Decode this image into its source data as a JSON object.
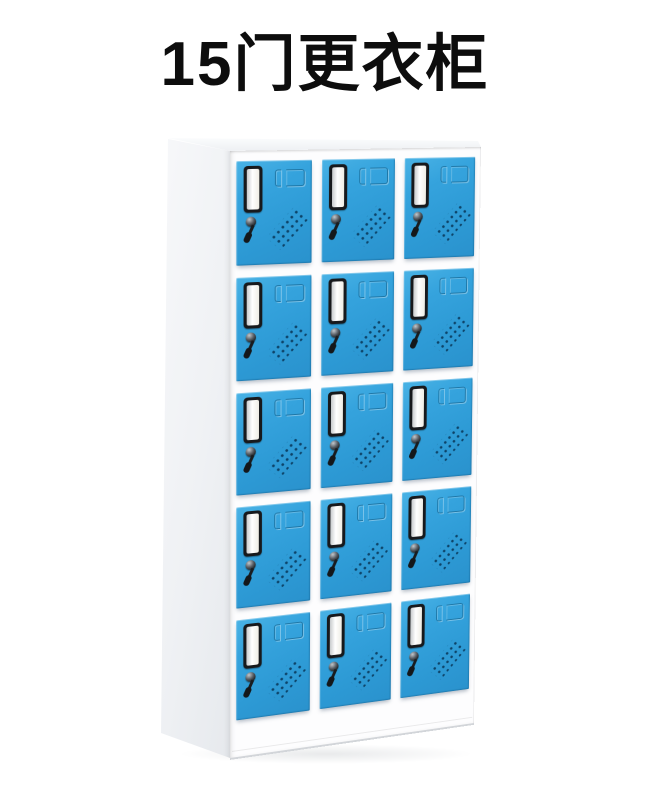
{
  "page": {
    "background": "#ffffff"
  },
  "title": "15门更衣柜",
  "cabinet": {
    "kind": "15-door staff locker / wardrobe cabinet",
    "rows": 5,
    "columns": 3,
    "door_count": 15,
    "colors": {
      "door_blue": "#2f9ed9",
      "door_blue_light": "#49b2e5",
      "door_blue_dark": "#2a92cd",
      "body_white": "#fdfdfe",
      "side_panel_gray": "#eff1f4",
      "vent_hole_navy": "#0d4368",
      "card_slot_frame_black": "#17191c",
      "card_slot_paper": "#f4f2ea",
      "title_black": "#0d0d0d"
    },
    "door_features": [
      "label-card-slot",
      "recessed-handle",
      "lock-with-hanging-key",
      "diagonal-vent-holes"
    ]
  }
}
